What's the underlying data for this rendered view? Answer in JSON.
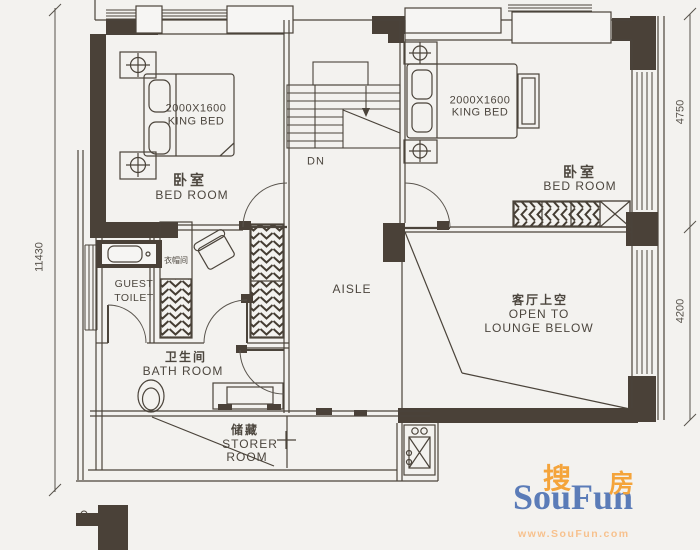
{
  "plan": {
    "dimensions": {
      "left_total": "11430",
      "right_upper": "4750",
      "right_lower": "4200"
    },
    "stairs": {
      "down": "DN"
    },
    "rooms": {
      "bedroom_left": {
        "zh": "卧室",
        "en": "BED ROOM"
      },
      "bedroom_right": {
        "zh": "卧室",
        "en": "BED ROOM"
      },
      "aisle": {
        "en": "AISLE"
      },
      "cloakroom": {
        "zh": "衣帽间"
      },
      "guest_toilet": {
        "en_line1": "GUEST",
        "en_line2": "TOILET"
      },
      "bathroom": {
        "zh": "卫生间",
        "en": "BATH ROOM"
      },
      "storeroom": {
        "zh": "储藏",
        "en_line1": "STORER",
        "en_line2": "ROOM"
      },
      "lounge_void": {
        "zh": "客厅上空",
        "en_line1": "OPEN TO",
        "en_line2": "LOUNGE BELOW"
      }
    },
    "furniture": {
      "bed_left": {
        "size": "2000X1600",
        "type": "KING BED"
      },
      "bed_right": {
        "size": "2000X1600",
        "type": "KING BED"
      }
    }
  },
  "logo": {
    "zh_char1": "搜",
    "zh_char2": "房",
    "brand": "SouFun",
    "url": "www.SouFun.com"
  },
  "colors": {
    "wall_fill": "#4a4138",
    "line": "#4b443b",
    "background": "#f3f2ef",
    "logo_blue": "#5b7cb8",
    "logo_orange": "#f4a43b",
    "logo_url_orange": "#f7c18d"
  }
}
